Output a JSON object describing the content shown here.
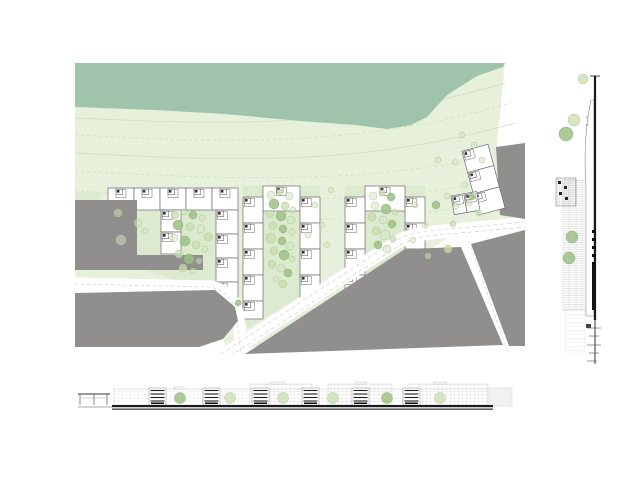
{
  "title": "architectural site plan with elevations",
  "canvas": {
    "w": 620,
    "h": 480,
    "bg": "#ffffff"
  },
  "colors": {
    "field": "#e6f0db",
    "band": "#9fc3ab",
    "courtyard": "#dcead0",
    "gray": "#908f8d",
    "road": "#ffffff",
    "dash": "#c9c9c9",
    "outline": "#6b6b6b",
    "contour": "#c9dcc0",
    "tree_light": "#c9ddae",
    "tree_dark": "#9dc185",
    "tree_faint": "#d4e4c2",
    "tree_edge": "#a9c68d",
    "black": "#1a1a1a",
    "hatch": "#c6c6c6",
    "grid": "#dcdcdc",
    "section_edge": "#8a8a8a",
    "plain_block": "#f1f1f0"
  },
  "plan": {
    "x": 75,
    "y": 63,
    "w": 450,
    "h": 292,
    "field": "0,0 430,0 421,92 447,155 447,163 380,170 330,204 240,266 152,292 140,240 136,222 0,216",
    "band": "0,0 430,0 428,4 402,13 372,32 352,54 336,62 312,66 280,62 225,58 150,51 80,47 0,44",
    "contours": [
      {
        "d": "M0,55 C120,60 260,70 430,20",
        "dash": false
      },
      {
        "d": "M0,72 C130,78 270,88 436,40",
        "dash": true
      },
      {
        "d": "M0,90 C140,97 280,106 440,60",
        "dash": false
      },
      {
        "d": "M0,108 C150,116 300,124 444,86",
        "dash": true
      },
      {
        "d": "M0,128 C160,137 300,146 447,112",
        "dash": true
      },
      {
        "d": "M60,150 C180,158 310,165 448,132",
        "dash": true
      }
    ],
    "green_patches": [
      [
        0,
        129,
        25,
        8
      ],
      [
        7,
        147,
        13,
        13
      ]
    ],
    "courtyards": [
      "33,147 141,147 141,217 100,217 33,194",
      "168,123 245,123 245,222 168,268",
      "270,123 350,123 350,198 270,238"
    ],
    "units": [
      [
        33,
        125,
        26,
        22,
        "tm"
      ],
      [
        59,
        125,
        26,
        22,
        "tm"
      ],
      [
        85,
        125,
        26,
        22,
        "tm"
      ],
      [
        111,
        125,
        26,
        22,
        "tm"
      ],
      [
        137,
        125,
        26,
        22,
        "tm"
      ],
      [
        141,
        147,
        22,
        24,
        "tl"
      ],
      [
        141,
        171,
        22,
        24,
        "tl"
      ],
      [
        141,
        195,
        22,
        24,
        "tl"
      ],
      [
        141,
        219,
        22,
        15,
        "tl"
      ],
      [
        86,
        147,
        20,
        22,
        "tl"
      ],
      [
        86,
        169,
        20,
        22,
        "tl"
      ],
      [
        188,
        123,
        37,
        25,
        "tm"
      ],
      [
        168,
        134,
        20,
        26,
        "tl"
      ],
      [
        168,
        160,
        20,
        26,
        "tl"
      ],
      [
        168,
        186,
        20,
        26,
        "tl"
      ],
      [
        168,
        212,
        20,
        26,
        "tl"
      ],
      [
        168,
        238,
        20,
        18,
        "tl"
      ],
      [
        225,
        134,
        20,
        26,
        "tl"
      ],
      [
        225,
        160,
        20,
        26,
        "tl"
      ],
      [
        225,
        186,
        20,
        26,
        "tl"
      ],
      [
        225,
        212,
        20,
        22,
        "tl"
      ],
      [
        290,
        123,
        40,
        25,
        "tm"
      ],
      [
        270,
        134,
        20,
        26,
        "tl"
      ],
      [
        270,
        160,
        20,
        26,
        "tl"
      ],
      [
        270,
        186,
        20,
        26,
        "tl"
      ],
      [
        270,
        212,
        20,
        14,
        "tl"
      ],
      [
        330,
        134,
        20,
        26,
        "tl"
      ],
      [
        330,
        160,
        20,
        26,
        "tl"
      ],
      [
        330,
        186,
        20,
        13,
        "tl"
      ]
    ],
    "rot_groups": [
      {
        "tx": 404,
        "ty": 152,
        "rot": -15,
        "units": [
          [
            0,
            -22,
            27,
            22,
            "tl"
          ],
          [
            0,
            -44,
            27,
            22,
            "tl"
          ],
          [
            0,
            -66,
            27,
            22,
            "tl"
          ]
        ]
      },
      {
        "tx": 376,
        "ty": 133,
        "rot": -10,
        "units": [
          [
            0,
            0,
            13,
            19,
            "tl"
          ],
          [
            13,
            0,
            13,
            19,
            "tl"
          ]
        ]
      }
    ],
    "roads": [
      {
        "d": "M146,294 L316,183 C328,175 338,172 352,170 L450,161",
        "w": 14
      },
      {
        "d": "M0,221 L134,224 C152,226 160,238 163,254 L168,292",
        "w": 13
      },
      {
        "d": "M394,178 L433,290",
        "w": 9
      }
    ],
    "dashes": [
      {
        "d": "M146,291 L315,181 C327,173 338,170 352,168 L450,159",
        "dash": "4 3"
      },
      {
        "d": "M149,297 L319,186 C330,178 340,175 353,173 L450,164",
        "dash": "4 3"
      },
      {
        "d": "M0,221 L134,224 C150,226 158,236 161,252 L166,290",
        "dash": "3 3"
      },
      {
        "d": "M394,178 L433,290",
        "dash": "3 3"
      }
    ],
    "grays": [
      "0,137 62,137 62,192 0,192",
      "0,192 128,192 128,207 0,207",
      "0,230 140,227 160,244 163,258 148,276 124,284 0,284",
      "170,291 330,186 386,184 428,282",
      "396,181 450,167 450,283 434,283",
      "421,84 450,80 450,156 425,152"
    ],
    "trees": [
      [
        43,
        150,
        4,
        2
      ],
      [
        63,
        160,
        4,
        2
      ],
      [
        46,
        177,
        5,
        2
      ],
      [
        70,
        168,
        3,
        2
      ],
      [
        100,
        152,
        4,
        0
      ],
      [
        109,
        149,
        3,
        2
      ],
      [
        118,
        152,
        4,
        1
      ],
      [
        127,
        155,
        3,
        2
      ],
      [
        103,
        162,
        5,
        1
      ],
      [
        115,
        164,
        4,
        0
      ],
      [
        126,
        166,
        4,
        2
      ],
      [
        133,
        174,
        4,
        0
      ],
      [
        99,
        175,
        4,
        2
      ],
      [
        110,
        178,
        5,
        1
      ],
      [
        121,
        182,
        4,
        0
      ],
      [
        130,
        186,
        3,
        2
      ],
      [
        104,
        191,
        4,
        0
      ],
      [
        114,
        196,
        5,
        1
      ],
      [
        124,
        198,
        3,
        2
      ],
      [
        108,
        205,
        4,
        0
      ],
      [
        118,
        208,
        3,
        2
      ],
      [
        196,
        132,
        4,
        2
      ],
      [
        205,
        129,
        3,
        0
      ],
      [
        214,
        133,
        4,
        2
      ],
      [
        199,
        141,
        5,
        1
      ],
      [
        210,
        143,
        4,
        0
      ],
      [
        218,
        147,
        3,
        2
      ],
      [
        195,
        151,
        4,
        0
      ],
      [
        206,
        153,
        5,
        1
      ],
      [
        216,
        157,
        4,
        2
      ],
      [
        198,
        163,
        4,
        0
      ],
      [
        208,
        166,
        4,
        1
      ],
      [
        217,
        169,
        3,
        2
      ],
      [
        196,
        175,
        5,
        0
      ],
      [
        207,
        178,
        4,
        1
      ],
      [
        215,
        183,
        4,
        2
      ],
      [
        199,
        188,
        4,
        0
      ],
      [
        209,
        192,
        5,
        1
      ],
      [
        217,
        196,
        3,
        2
      ],
      [
        197,
        201,
        4,
        0
      ],
      [
        206,
        205,
        4,
        2
      ],
      [
        213,
        210,
        4,
        1
      ],
      [
        201,
        216,
        3,
        2
      ],
      [
        208,
        221,
        4,
        0
      ],
      [
        298,
        133,
        4,
        2
      ],
      [
        307,
        130,
        3,
        0
      ],
      [
        316,
        134,
        4,
        1
      ],
      [
        300,
        143,
        4,
        2
      ],
      [
        311,
        146,
        5,
        1
      ],
      [
        320,
        149,
        3,
        2
      ],
      [
        297,
        154,
        4,
        0
      ],
      [
        308,
        157,
        4,
        2
      ],
      [
        317,
        161,
        4,
        1
      ],
      [
        301,
        168,
        4,
        0
      ],
      [
        310,
        172,
        5,
        2
      ],
      [
        318,
        176,
        3,
        0
      ],
      [
        303,
        182,
        4,
        1
      ],
      [
        312,
        186,
        4,
        2
      ],
      [
        240,
        142,
        3,
        2
      ],
      [
        247,
        162,
        3,
        2
      ],
      [
        252,
        182,
        3,
        2
      ],
      [
        233,
        172,
        3,
        2
      ],
      [
        256,
        127,
        3,
        2
      ],
      [
        340,
        142,
        3,
        2
      ],
      [
        350,
        162,
        3,
        2
      ],
      [
        338,
        177,
        3,
        2
      ],
      [
        361,
        142,
        4,
        1
      ],
      [
        372,
        133,
        3,
        2
      ],
      [
        381,
        143,
        3,
        2
      ],
      [
        378,
        161,
        3,
        0
      ],
      [
        363,
        97,
        3,
        2
      ],
      [
        390,
        122,
        3,
        2
      ],
      [
        397,
        134,
        3,
        1
      ],
      [
        373,
        186,
        4,
        0
      ],
      [
        353,
        193,
        3,
        2
      ],
      [
        387,
        72,
        3,
        2
      ],
      [
        399,
        82,
        3,
        2
      ],
      [
        407,
        97,
        3,
        2
      ],
      [
        380,
        99,
        3,
        2
      ],
      [
        163,
        240,
        3,
        1
      ],
      [
        394,
        140,
        3,
        2
      ],
      [
        404,
        150,
        3,
        0
      ]
    ]
  },
  "side_elevation": {
    "x": 553,
    "y": 58,
    "w": 50,
    "h": 310,
    "spine": [
      {
        "x": 42,
        "y1": 18,
        "y2": 262,
        "w": 2.2
      },
      {
        "x": 42,
        "y1": 262,
        "y2": 306,
        "w": 0.9
      }
    ],
    "top_tick": [
      37,
      18,
      47,
      18
    ],
    "outline_path": "M38,42 C32,70 31,100 33,130 L33,258 L41,258 L41,42 Z",
    "marks": [
      [
        34,
        59
      ],
      [
        34,
        67
      ]
    ],
    "hatch_band": [
      10,
      122,
      23,
      130
    ],
    "hatch_light": [
      12,
      252,
      20,
      42
    ],
    "dark_block": [
      3,
      120,
      20,
      28
    ],
    "black_cells": [
      [
        39,
        172,
        4,
        3
      ],
      [
        39,
        180,
        4,
        3
      ],
      [
        39,
        188,
        4,
        3
      ],
      [
        39,
        196,
        4,
        3
      ]
    ],
    "black_bar": [
      39,
      204,
      3,
      48
    ],
    "small_block": [
      33,
      266,
      5,
      4
    ],
    "ticks": [
      [
        34,
        270,
        48,
        270
      ],
      [
        36,
        278,
        46,
        278
      ],
      [
        34,
        287,
        48,
        287
      ],
      [
        36,
        295,
        46,
        295
      ],
      [
        34,
        303,
        44,
        303
      ]
    ],
    "trees": [
      [
        30,
        21,
        5,
        0
      ],
      [
        21,
        62,
        6,
        0
      ],
      [
        13,
        76,
        7,
        1
      ],
      [
        19,
        179,
        6,
        1
      ],
      [
        16,
        200,
        6,
        1
      ]
    ]
  },
  "bottom_elevation": {
    "x": 74,
    "y": 381,
    "w": 440,
    "h": 35,
    "ground_thin": [
      4,
      26,
      38,
      26
    ],
    "ground_bar1": [
      38,
      24,
      381,
      2.2
    ],
    "ground_bar2": [
      38,
      27.6,
      381,
      1.1
    ],
    "canopy_roof": [
      4,
      13,
      36,
      13
    ],
    "canopy_mid": [
      7,
      17,
      34,
      17
    ],
    "canopy_posts": [
      [
        6,
        13,
        6,
        24
      ],
      [
        20,
        13,
        20,
        24
      ],
      [
        33,
        13,
        33,
        24
      ]
    ],
    "grid_blocks": [
      [
        40,
        8,
        374,
        16
      ],
      [
        176,
        3,
        62,
        21
      ],
      [
        254,
        3,
        64,
        21
      ],
      [
        334,
        3,
        80,
        21
      ]
    ],
    "plain_block": [
      414,
      7,
      24,
      18
    ],
    "roof_bits": [
      [
        100,
        6,
        10,
        2
      ],
      [
        196,
        1,
        14,
        2
      ],
      [
        282,
        1,
        10,
        2
      ],
      [
        360,
        1,
        12,
        2
      ]
    ],
    "sections": [
      [
        75,
        7,
        17,
        17
      ],
      [
        129,
        7,
        17,
        17
      ],
      [
        178,
        7,
        17,
        17
      ],
      [
        228,
        7,
        17,
        17
      ],
      [
        278,
        7,
        17,
        17
      ],
      [
        329,
        7,
        17,
        17
      ]
    ],
    "trees": [
      [
        106,
        17,
        5.5,
        1
      ],
      [
        156,
        17,
        5.5,
        0
      ],
      [
        209,
        17,
        5.5,
        0
      ],
      [
        259,
        17,
        5.5,
        0
      ],
      [
        313,
        17,
        5.5,
        1
      ],
      [
        366,
        17,
        5.5,
        0
      ]
    ]
  }
}
